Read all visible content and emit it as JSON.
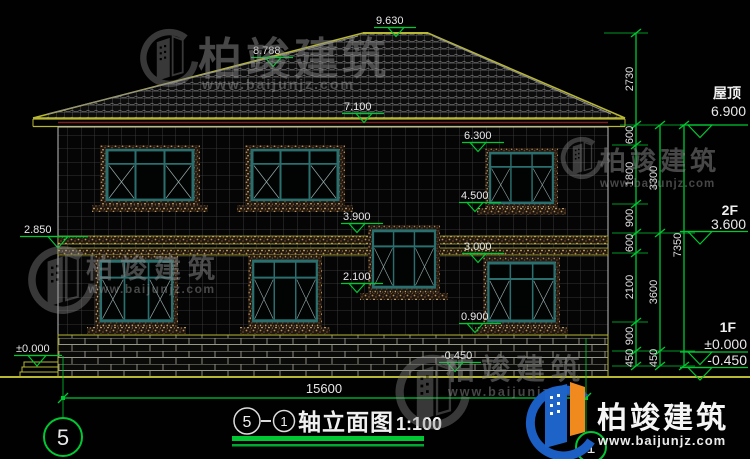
{
  "title": {
    "axis_left": "5",
    "axis_right": "1",
    "name": "轴立面图",
    "scale": "1:100"
  },
  "watermark": {
    "brand": "柏竣建筑",
    "url": "www.baijunjz.com"
  },
  "axes": {
    "left": "5",
    "right": "1"
  },
  "levels": {
    "ridge": "9.630",
    "roof_left": "8.788",
    "eave": "7.100",
    "w2f_top": "6.300",
    "w2f_sill": "4.500",
    "stair_top": "3.900",
    "stair_sill": "2.100",
    "w1f_top": "3.000",
    "w1f_sill": "0.900",
    "ground": "-0.450",
    "left_band": "2.850",
    "left_zero": "±0.000"
  },
  "right_levels": {
    "roof_label": "屋顶",
    "roof_value": "6.900",
    "f2_label": "2F",
    "f2_value": "3.600",
    "f1_label": "1F",
    "f1_value": "±0.000",
    "base_value": "-0.450"
  },
  "dims": {
    "total_width": "15600",
    "inner": [
      "2730",
      "600",
      "1800",
      "900",
      "600",
      "2100",
      "900",
      "450"
    ],
    "mid": [
      "3300",
      "3600",
      "450"
    ],
    "outer": "7350"
  },
  "colors": {
    "dimension_green": "#00c832",
    "outline_olive": "#b8b832",
    "window_teal": "#2a6e6e",
    "brand_blue": "#1b5ec4",
    "brand_orange": "#f08a1e"
  }
}
